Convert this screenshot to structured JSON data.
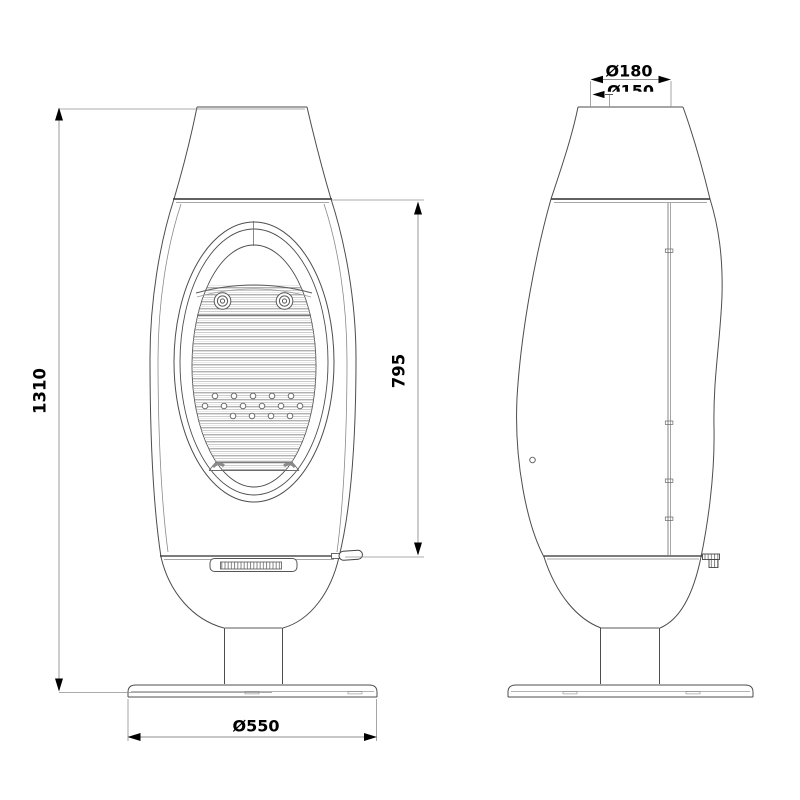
{
  "drawing": {
    "dimensions": {
      "overall_height": "1310",
      "firebox_height": "795",
      "base_diameter": "Ø550",
      "flue_outer_diameter": "Ø180",
      "flue_inner_diameter": "Ø150"
    },
    "colors": {
      "background": "#ffffff",
      "outline": "#4d4d4d",
      "joint_line": "#2e2e2e",
      "dimension_line": "#8f8f8f",
      "annotation": "#000000"
    }
  }
}
